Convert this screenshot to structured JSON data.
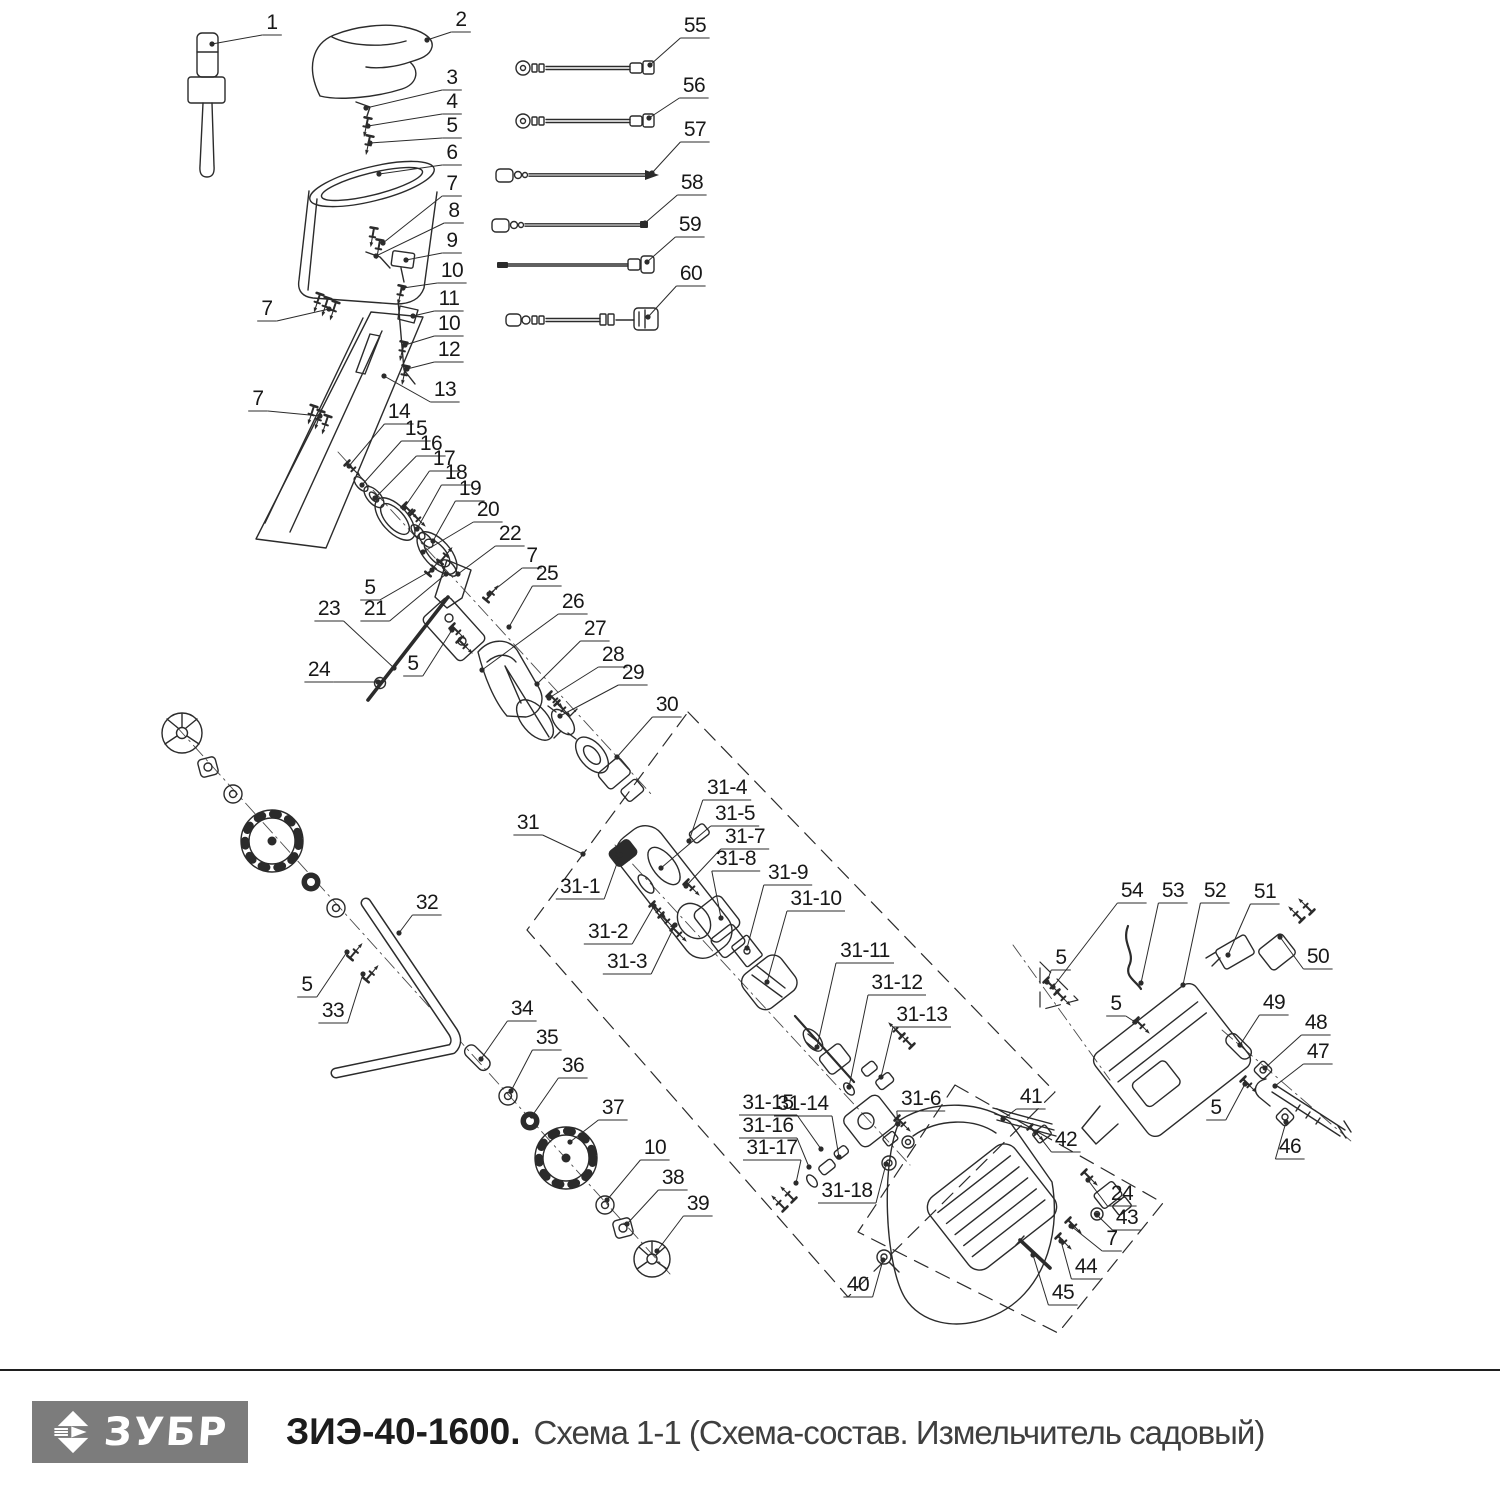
{
  "colors": {
    "background": "#ffffff",
    "line": "#2b2b2b",
    "label": "#181818",
    "logo_bg": "#7c7c7c",
    "logo_text": "#ffffff",
    "model_text": "#1c1c1c",
    "subtitle_text": "#3f3f3f"
  },
  "footer": {
    "brand": "ЗУБР",
    "model": "ЗИЭ-40-1600.",
    "subtitle": "Схема 1-1 (Схема-состав. Измельчитель садовый)"
  },
  "callouts": [
    {
      "l": "1",
      "x": 272,
      "y": 22,
      "t": [
        212,
        44
      ]
    },
    {
      "l": "2",
      "x": 461,
      "y": 19,
      "t": [
        427,
        40
      ]
    },
    {
      "l": "3",
      "x": 452,
      "y": 77,
      "t": [
        366,
        108
      ]
    },
    {
      "l": "4",
      "x": 452,
      "y": 101,
      "t": [
        368,
        126
      ]
    },
    {
      "l": "5",
      "x": 452,
      "y": 125,
      "t": [
        370,
        143
      ]
    },
    {
      "l": "6",
      "x": 452,
      "y": 152,
      "t": [
        379,
        174
      ]
    },
    {
      "l": "7",
      "x": 452,
      "y": 183,
      "t": [
        383,
        243
      ]
    },
    {
      "l": "8",
      "x": 454,
      "y": 210,
      "t": [
        376,
        256
      ]
    },
    {
      "l": "9",
      "x": 452,
      "y": 240,
      "t": [
        406,
        260
      ]
    },
    {
      "l": "10",
      "x": 452,
      "y": 270,
      "t": [
        403,
        288
      ]
    },
    {
      "l": "11",
      "x": 449,
      "y": 298,
      "t": [
        413,
        316
      ]
    },
    {
      "l": "10",
      "x": 449,
      "y": 323,
      "t": [
        405,
        345
      ]
    },
    {
      "l": "12",
      "x": 449,
      "y": 349,
      "t": [
        407,
        369
      ]
    },
    {
      "l": "13",
      "x": 445,
      "y": 389,
      "t": [
        384,
        376
      ]
    },
    {
      "l": "7",
      "x": 267,
      "y": 308,
      "t": [
        329,
        309
      ]
    },
    {
      "l": "7",
      "x": 258,
      "y": 398,
      "t": [
        320,
        416
      ]
    },
    {
      "l": "14",
      "x": 399,
      "y": 411,
      "t": [
        349,
        466
      ]
    },
    {
      "l": "15",
      "x": 416,
      "y": 428,
      "t": [
        362,
        485
      ]
    },
    {
      "l": "16",
      "x": 431,
      "y": 443,
      "t": [
        375,
        498
      ]
    },
    {
      "l": "17",
      "x": 444,
      "y": 458,
      "t": [
        404,
        508
      ]
    },
    {
      "l": "18",
      "x": 456,
      "y": 472,
      "t": [
        417,
        529
      ]
    },
    {
      "l": "19",
      "x": 470,
      "y": 488,
      "t": [
        433,
        541
      ]
    },
    {
      "l": "20",
      "x": 488,
      "y": 509,
      "t": [
        423,
        552
      ]
    },
    {
      "l": "22",
      "x": 510,
      "y": 533,
      "t": [
        458,
        574
      ]
    },
    {
      "l": "7",
      "x": 532,
      "y": 555,
      "t": [
        489,
        594
      ]
    },
    {
      "l": "25",
      "x": 547,
      "y": 573,
      "t": [
        509,
        627
      ]
    },
    {
      "l": "26",
      "x": 573,
      "y": 601,
      "t": [
        482,
        670
      ]
    },
    {
      "l": "27",
      "x": 595,
      "y": 628,
      "t": [
        537,
        684
      ]
    },
    {
      "l": "28",
      "x": 613,
      "y": 654,
      "t": [
        549,
        698
      ]
    },
    {
      "l": "29",
      "x": 633,
      "y": 672,
      "t": [
        560,
        716
      ]
    },
    {
      "l": "30",
      "x": 667,
      "y": 704,
      "t": [
        617,
        757
      ]
    },
    {
      "l": "5",
      "x": 370,
      "y": 587,
      "t": [
        432,
        570
      ]
    },
    {
      "l": "21",
      "x": 375,
      "y": 608,
      "t": [
        446,
        574
      ]
    },
    {
      "l": "23",
      "x": 329,
      "y": 608,
      "t": [
        394,
        668
      ]
    },
    {
      "l": "24",
      "x": 319,
      "y": 669,
      "t": [
        378,
        682
      ]
    },
    {
      "l": "5",
      "x": 413,
      "y": 663,
      "t": [
        452,
        630
      ]
    },
    {
      "l": "55",
      "x": 695,
      "y": 25,
      "t": [
        650,
        65
      ]
    },
    {
      "l": "56",
      "x": 694,
      "y": 85,
      "t": [
        649,
        118
      ]
    },
    {
      "l": "57",
      "x": 695,
      "y": 129,
      "t": [
        652,
        173
      ]
    },
    {
      "l": "58",
      "x": 692,
      "y": 182,
      "t": [
        645,
        223
      ]
    },
    {
      "l": "59",
      "x": 690,
      "y": 224,
      "t": [
        647,
        262
      ]
    },
    {
      "l": "60",
      "x": 691,
      "y": 273,
      "t": [
        648,
        317
      ]
    },
    {
      "l": "31",
      "x": 528,
      "y": 822,
      "t": [
        583,
        854
      ]
    },
    {
      "l": "31-1",
      "x": 580,
      "y": 886,
      "t": [
        620,
        855
      ]
    },
    {
      "l": "31-2",
      "x": 608,
      "y": 931,
      "t": [
        654,
        906
      ]
    },
    {
      "l": "31-3",
      "x": 627,
      "y": 961,
      "t": [
        675,
        925
      ]
    },
    {
      "l": "31-4",
      "x": 727,
      "y": 787,
      "t": [
        689,
        841
      ]
    },
    {
      "l": "31-5",
      "x": 735,
      "y": 813,
      "t": [
        661,
        868
      ]
    },
    {
      "l": "31-7",
      "x": 745,
      "y": 836,
      "t": [
        686,
        886
      ]
    },
    {
      "l": "31-8",
      "x": 736,
      "y": 858,
      "t": [
        721,
        918
      ]
    },
    {
      "l": "31-9",
      "x": 788,
      "y": 872,
      "t": [
        747,
        948
      ]
    },
    {
      "l": "31-10",
      "x": 816,
      "y": 898,
      "t": [
        767,
        982
      ]
    },
    {
      "l": "31-11",
      "x": 865,
      "y": 950,
      "t": [
        817,
        1047
      ]
    },
    {
      "l": "31-12",
      "x": 897,
      "y": 982,
      "t": [
        849,
        1087
      ]
    },
    {
      "l": "31-13",
      "x": 922,
      "y": 1014,
      "t": [
        881,
        1077
      ]
    },
    {
      "l": "31-14",
      "x": 803,
      "y": 1103,
      "t": [
        839,
        1157
      ]
    },
    {
      "l": "31-15",
      "x": 768,
      "y": 1102,
      "t": [
        821,
        1149
      ]
    },
    {
      "l": "31-16",
      "x": 768,
      "y": 1125,
      "t": [
        809,
        1167
      ]
    },
    {
      "l": "31-17",
      "x": 772,
      "y": 1147,
      "t": [
        796,
        1183
      ]
    },
    {
      "l": "31-18",
      "x": 847,
      "y": 1190,
      "t": [
        886,
        1164
      ]
    },
    {
      "l": "31-6",
      "x": 921,
      "y": 1098,
      "t": [
        898,
        1124
      ]
    },
    {
      "l": "32",
      "x": 427,
      "y": 902,
      "t": [
        399,
        933
      ]
    },
    {
      "l": "5",
      "x": 307,
      "y": 984,
      "t": [
        347,
        952
      ]
    },
    {
      "l": "33",
      "x": 333,
      "y": 1010,
      "t": [
        363,
        974
      ]
    },
    {
      "l": "34",
      "x": 522,
      "y": 1008,
      "t": [
        481,
        1059
      ]
    },
    {
      "l": "35",
      "x": 547,
      "y": 1037,
      "t": [
        511,
        1091
      ]
    },
    {
      "l": "36",
      "x": 573,
      "y": 1065,
      "t": [
        532,
        1116
      ]
    },
    {
      "l": "37",
      "x": 613,
      "y": 1107,
      "t": [
        570,
        1142
      ]
    },
    {
      "l": "10",
      "x": 655,
      "y": 1147,
      "t": [
        607,
        1200
      ]
    },
    {
      "l": "38",
      "x": 673,
      "y": 1177,
      "t": [
        627,
        1224
      ]
    },
    {
      "l": "39",
      "x": 698,
      "y": 1203,
      "t": [
        657,
        1251
      ]
    },
    {
      "l": "40",
      "x": 858,
      "y": 1284,
      "t": [
        883,
        1260
      ]
    },
    {
      "l": "41",
      "x": 1031,
      "y": 1096,
      "t": [
        1003,
        1119
      ]
    },
    {
      "l": "42",
      "x": 1066,
      "y": 1139,
      "t": [
        1036,
        1132
      ]
    },
    {
      "l": "24",
      "x": 1122,
      "y": 1193,
      "t": [
        1088,
        1180
      ]
    },
    {
      "l": "43",
      "x": 1127,
      "y": 1217,
      "t": [
        1097,
        1215
      ]
    },
    {
      "l": "7",
      "x": 1112,
      "y": 1238,
      "t": [
        1071,
        1226
      ]
    },
    {
      "l": "44",
      "x": 1086,
      "y": 1266,
      "t": [
        1061,
        1241
      ]
    },
    {
      "l": "45",
      "x": 1063,
      "y": 1292,
      "t": [
        1033,
        1255
      ]
    },
    {
      "l": "46",
      "x": 1290,
      "y": 1146,
      "t": [
        1286,
        1122
      ]
    },
    {
      "l": "47",
      "x": 1318,
      "y": 1051,
      "t": [
        1275,
        1086
      ]
    },
    {
      "l": "48",
      "x": 1316,
      "y": 1022,
      "t": [
        1265,
        1068
      ]
    },
    {
      "l": "49",
      "x": 1274,
      "y": 1002,
      "t": [
        1240,
        1045
      ]
    },
    {
      "l": "50",
      "x": 1318,
      "y": 956,
      "t": [
        1280,
        937
      ]
    },
    {
      "l": "51",
      "x": 1265,
      "y": 891,
      "t": [
        1228,
        955
      ]
    },
    {
      "l": "52",
      "x": 1215,
      "y": 890,
      "t": [
        1183,
        985
      ]
    },
    {
      "l": "53",
      "x": 1173,
      "y": 890,
      "t": [
        1141,
        983
      ]
    },
    {
      "l": "54",
      "x": 1132,
      "y": 890,
      "t": [
        1053,
        987
      ]
    },
    {
      "l": "5",
      "x": 1061,
      "y": 957,
      "t": [
        1047,
        982
      ]
    },
    {
      "l": "5",
      "x": 1116,
      "y": 1003,
      "t": [
        1135,
        1022
      ]
    },
    {
      "l": "5",
      "x": 1216,
      "y": 1107,
      "t": [
        1245,
        1084
      ]
    }
  ]
}
